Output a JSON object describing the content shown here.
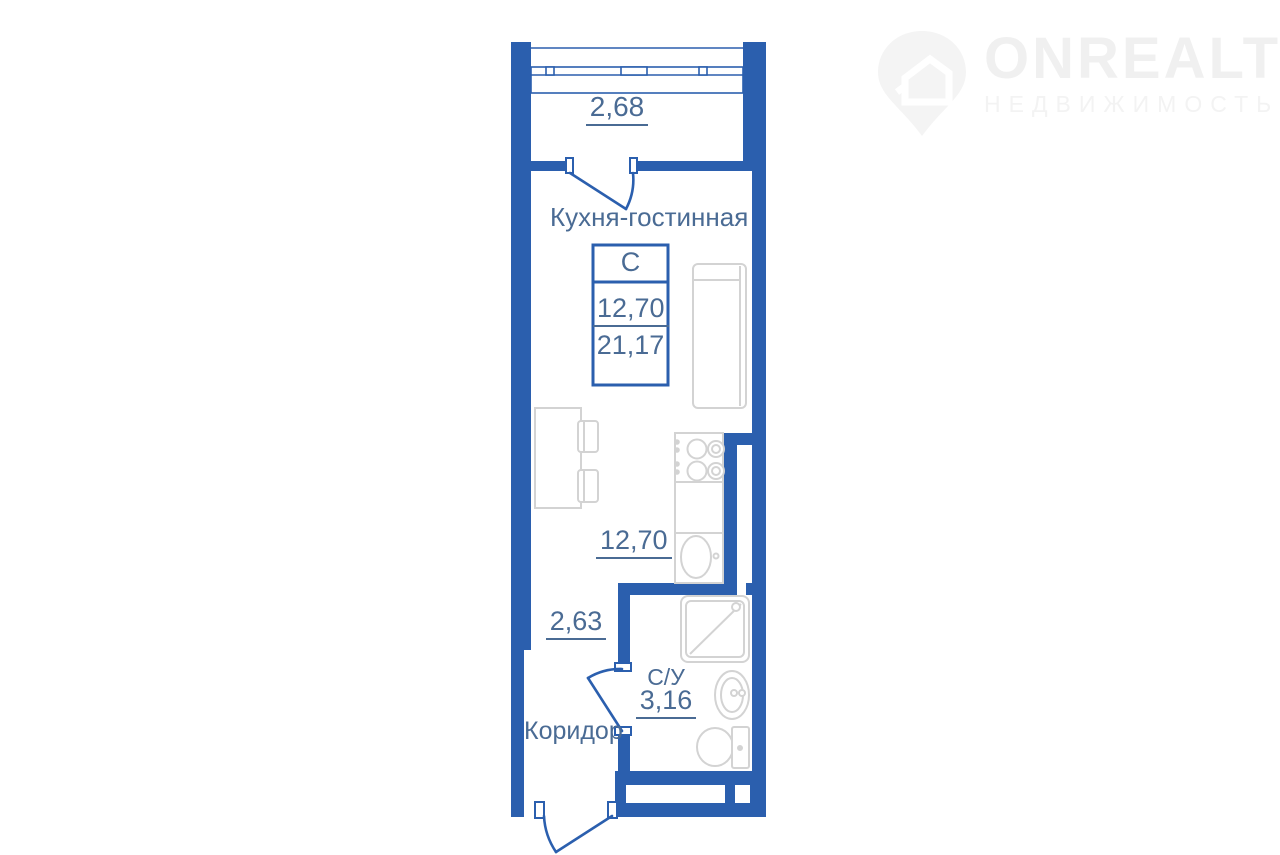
{
  "watermark": {
    "brand": "ONREALT",
    "subtitle": "НЕДВИЖИМОСТЬ"
  },
  "plan": {
    "balcony": {
      "area": "2,68"
    },
    "room": {
      "title": "Кухня-гостинная",
      "area": "12,70"
    },
    "info_box": {
      "type": "С",
      "area_living": "12,70",
      "area_total": "21,17"
    },
    "corridor": {
      "title": "Коридор",
      "area": "2,63"
    },
    "bathroom": {
      "title": "С/У",
      "area": "3,16"
    }
  },
  "colors": {
    "wall_blue": "#2b5fae",
    "label_slate": "#4a6b94",
    "furniture_gray": "#d3d3d3",
    "watermark_gray": "#f0f0f0"
  }
}
